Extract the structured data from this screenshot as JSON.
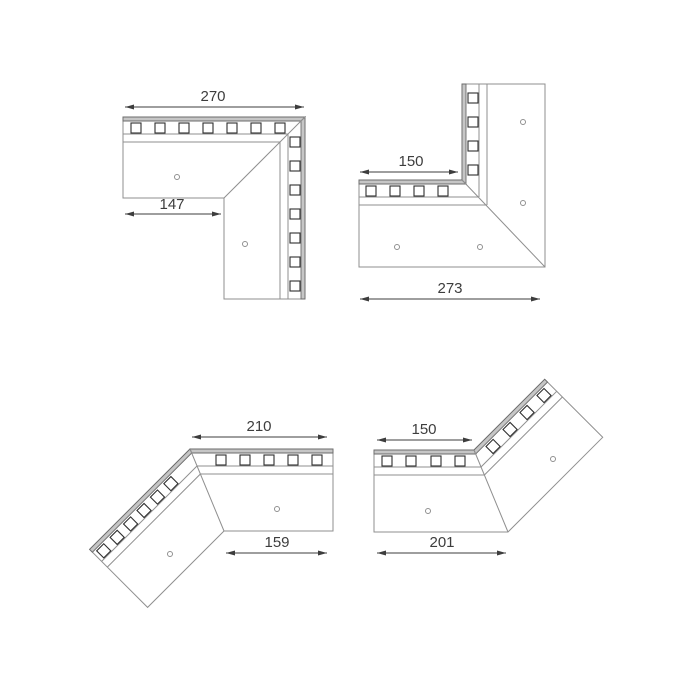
{
  "drawing": {
    "kind": "technical-drawing",
    "description": "Four mitered corner profile pieces shown in plan view with perforated mounting flanges and dimension callouts"
  },
  "figures": [
    {
      "id": "corner-90-strips-outside",
      "dims": {
        "leg": "270",
        "inner": "147"
      }
    },
    {
      "id": "corner-90-strips-inside",
      "dims": {
        "inner": "150",
        "leg": "273"
      }
    },
    {
      "id": "corner-135-strips-outside",
      "dims": {
        "leg": "210",
        "inner": "159"
      }
    },
    {
      "id": "corner-135-strips-inside",
      "dims": {
        "inner": "150",
        "leg": "201"
      }
    }
  ],
  "colors": {
    "line": "#8f8f8f",
    "dark": "#2f2f2f",
    "strip": "#c6c6c6",
    "strip_edge": "#6b6b6b",
    "dim": "#3d3d3d",
    "bg": "#ffffff",
    "hole_fill": "#ffffff"
  }
}
